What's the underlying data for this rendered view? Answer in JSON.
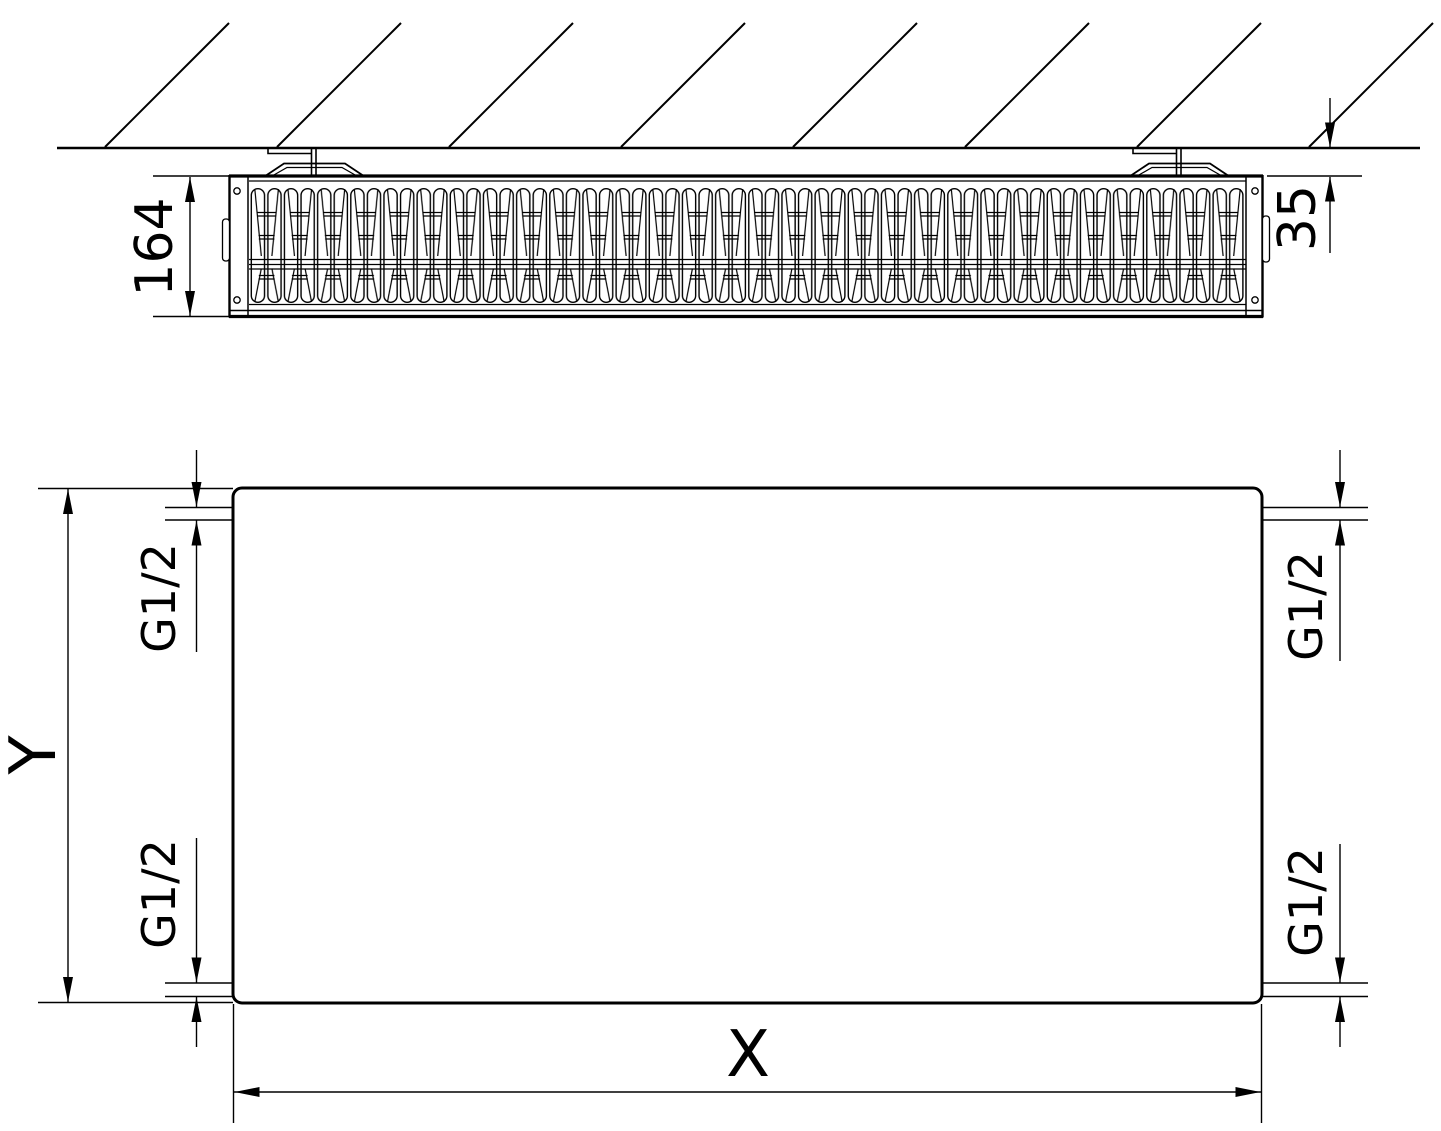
{
  "colors": {
    "line": "#000000",
    "background": "#ffffff"
  },
  "top_view": {
    "depth_dimension": "164",
    "wall_distance_dimension": "35"
  },
  "front_view": {
    "width_dimension": "X",
    "height_dimension": "Y",
    "connections": {
      "top_left": "G1/2",
      "bottom_left": "G1/2",
      "top_right": "G1/2",
      "bottom_right": "G1/2"
    }
  }
}
